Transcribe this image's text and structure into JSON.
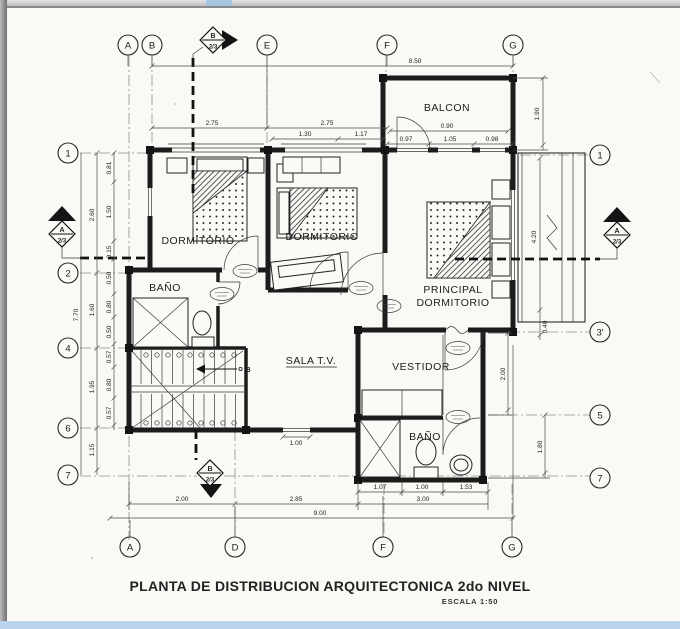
{
  "title": {
    "main": "PLANTA DE DISTRIBUCION ARQUITECTONICA 2do NIVEL",
    "scale": "ESCALA 1:50"
  },
  "rooms": {
    "balcon": "BALCON",
    "dormitorio1": "DORMITORIO",
    "dormitorio2": "DORMITORIO",
    "principal_line1": "PRINCIPAL",
    "principal_line2": "DORMITORIO",
    "bano1": "BAÑO",
    "bano2": "BAÑO",
    "sala_tv": "SALA T.V.",
    "vestidor": "VESTIDOR"
  },
  "stairs": {
    "direction_label": "B"
  },
  "grid_bubbles": {
    "top": [
      "A",
      "B",
      "E",
      "F",
      "G"
    ],
    "bottom": [
      "A",
      "D",
      "F",
      "G"
    ],
    "left": [
      "1",
      "2",
      "4",
      "6",
      "7"
    ],
    "right": [
      "1",
      "3'",
      "5",
      "7"
    ]
  },
  "section_markers": {
    "top": {
      "letter": "B",
      "sheet": "2/3"
    },
    "left": {
      "letter": "A",
      "sheet": "2/3"
    },
    "right": {
      "letter": "A",
      "sheet": "2/3"
    },
    "bottom": {
      "letter": "B",
      "sheet": "2/3"
    }
  },
  "dimensions": {
    "top_total": "8.50",
    "span_b_e": "2.75",
    "span_e_f": "2.75",
    "balcon_width": "0.90",
    "win1": "1.30",
    "win2": "1.17",
    "bal1": "0.97",
    "bal2": "1.05",
    "bal3": "0.98",
    "balcon_depth": "1.90",
    "roof_len": "4.20",
    "roof_end": "0.40",
    "vest_h": "2.00",
    "right_5_7": "1.80",
    "left_total": "7.70",
    "left_1_2": "2.60",
    "left_2_4": "1.60",
    "left_4_6": "1.95",
    "left_6_7": "1.15",
    "l1": "0.81",
    "l2": "1.50",
    "l3": "0.15",
    "l4": "0.50",
    "l5": "0.80",
    "l6": "0.50",
    "l7": "0.57",
    "l8": "0.80",
    "l9": "0.57",
    "sala_window": "1.00",
    "bath1": "1.07",
    "bath2": "1.00",
    "bath3": "1.53",
    "bath_total": "3.00",
    "bot_a_d": "2.00",
    "bot_d_f": "2.85",
    "bottom_total": "9.00"
  },
  "colors": {
    "paper": "#faf9f5",
    "ink": "#1c1c1c",
    "chrome_bottom_bar": "#b9d3ec",
    "chrome_tab": "#a6c6e2"
  }
}
